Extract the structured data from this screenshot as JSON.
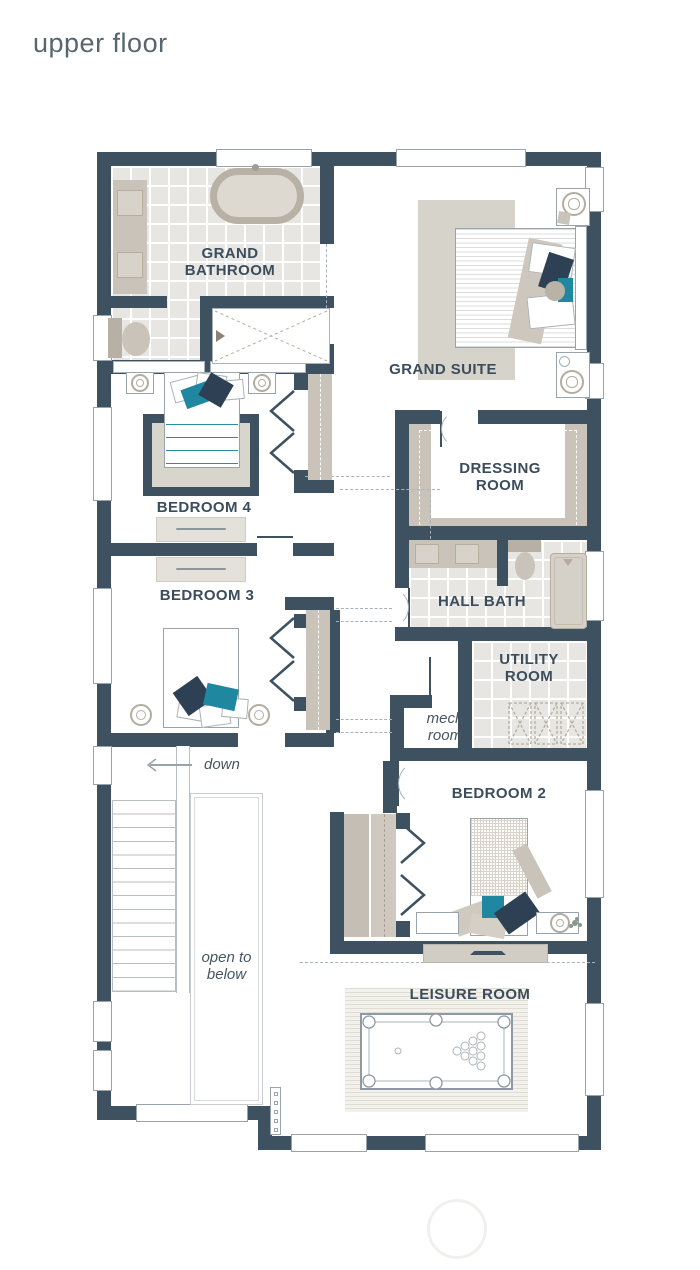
{
  "title": "upper floor",
  "palette": {
    "wall": "#3e5161",
    "label_text": "#3b4d5c",
    "title_text": "#56676f",
    "accent_teal": "#1f87a0",
    "accent_navy": "#2e4154",
    "furniture_beige": "#c9c3b9",
    "rug_beige": "#d6d3cb",
    "tile_gray": "#e8e6e2",
    "line_gray": "#98a3ab"
  },
  "rooms": {
    "grand_bathroom": {
      "label": "GRAND BATHROOM"
    },
    "grand_suite": {
      "label": "GRAND SUITE"
    },
    "bedroom_4": {
      "label": "BEDROOM 4"
    },
    "dressing_room": {
      "label": "DRESSING ROOM"
    },
    "bedroom_3": {
      "label": "BEDROOM 3"
    },
    "hall_bath": {
      "label": "HALL BATH"
    },
    "utility_room": {
      "label": "UTILITY ROOM"
    },
    "mech_room": {
      "label": "mech room"
    },
    "bedroom_2": {
      "label": "BEDROOM 2"
    },
    "leisure_room": {
      "label": "LEISURE ROOM"
    }
  },
  "annotations": {
    "stairs_direction": "down",
    "stairwell": "open to below"
  }
}
